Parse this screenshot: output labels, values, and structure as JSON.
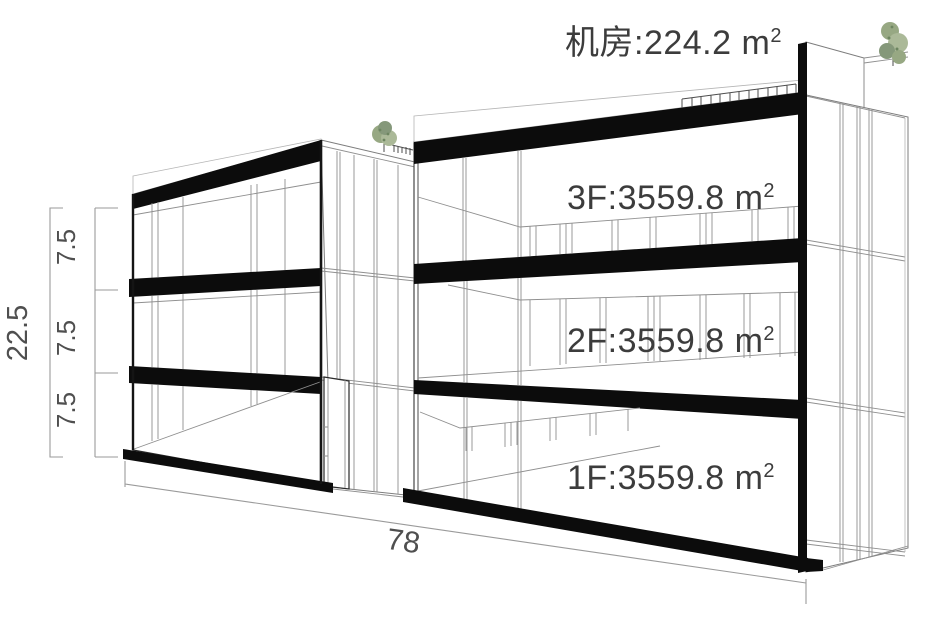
{
  "diagram": {
    "type": "building-massing-axonometric-section",
    "roof_label": {
      "text": "机房:224.2 m",
      "sup": "2"
    },
    "floor_labels": [
      {
        "floor": "3F",
        "text": "3F:3559.8 m",
        "sup": "2"
      },
      {
        "floor": "2F",
        "text": "2F:3559.8 m",
        "sup": "2"
      },
      {
        "floor": "1F",
        "text": "1F:3559.8 m",
        "sup": "2"
      }
    ],
    "dimensions": {
      "total_height": "22.5",
      "segments": [
        "7.5",
        "7.5",
        "7.5"
      ],
      "total_width": "78"
    },
    "colors": {
      "ink": "#141414",
      "slab": "#0c0c0c",
      "thin": "#8f8f8f",
      "dim": "#9a9a9a",
      "dim_text": "#4f4f4f",
      "label_text": "#3c3c3c",
      "tree": "#97a883",
      "tree_light": "#abb998",
      "bg": "#ffffff"
    }
  }
}
